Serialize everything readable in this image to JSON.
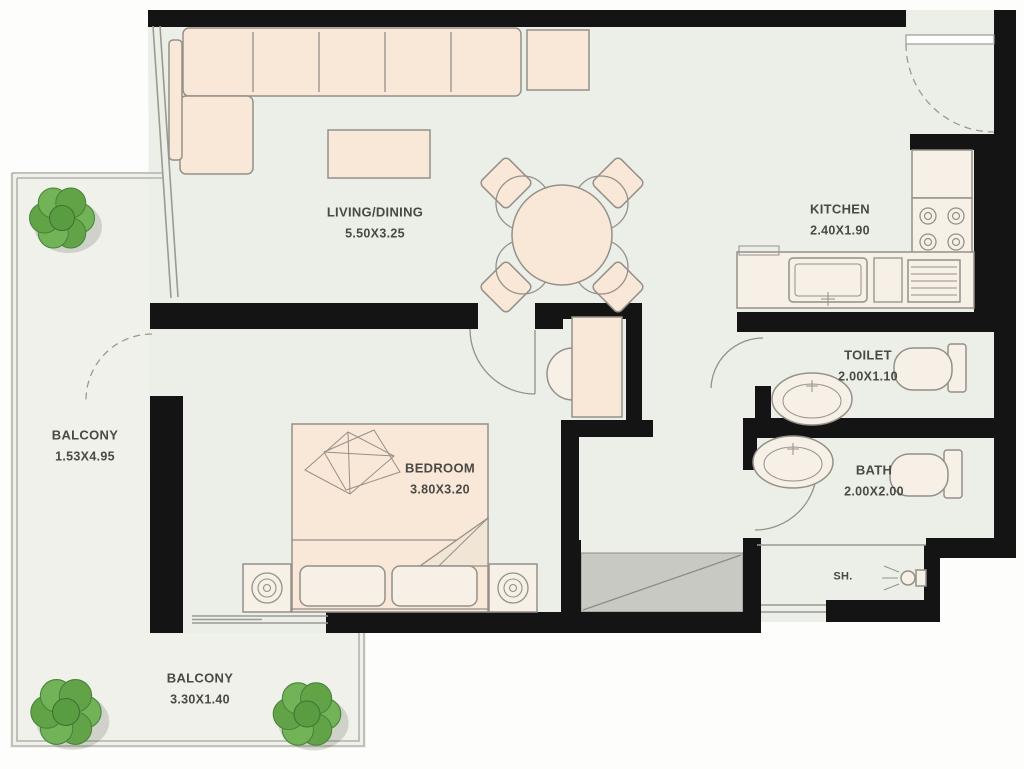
{
  "rooms": {
    "living": {
      "name": "LIVING/DINING",
      "dims": "5.50X3.25"
    },
    "kitchen": {
      "name": "KITCHEN",
      "dims": "2.40X1.90"
    },
    "toilet": {
      "name": "TOILET",
      "dims": "2.00X1.10"
    },
    "bath": {
      "name": "BATH",
      "dims": "2.00X2.00"
    },
    "bedroom": {
      "name": "BEDROOM",
      "dims": "3.80X3.20"
    },
    "balcony_left": {
      "name": "BALCONY",
      "dims": "1.53X4.95"
    },
    "balcony_bottom": {
      "name": "BALCONY",
      "dims": "3.30X1.40"
    },
    "shower": {
      "name": "SH."
    }
  },
  "colors": {
    "wall": "#141414",
    "floor": "#ecefe8",
    "balcony_floor": "#eff1ea",
    "furniture": "#f9e7d7",
    "fixture": "#f7f0e7",
    "stroke": "#94908a",
    "shaft": "#c9c9c4",
    "plant": "#6aa84f",
    "text": "#4a4a45"
  }
}
